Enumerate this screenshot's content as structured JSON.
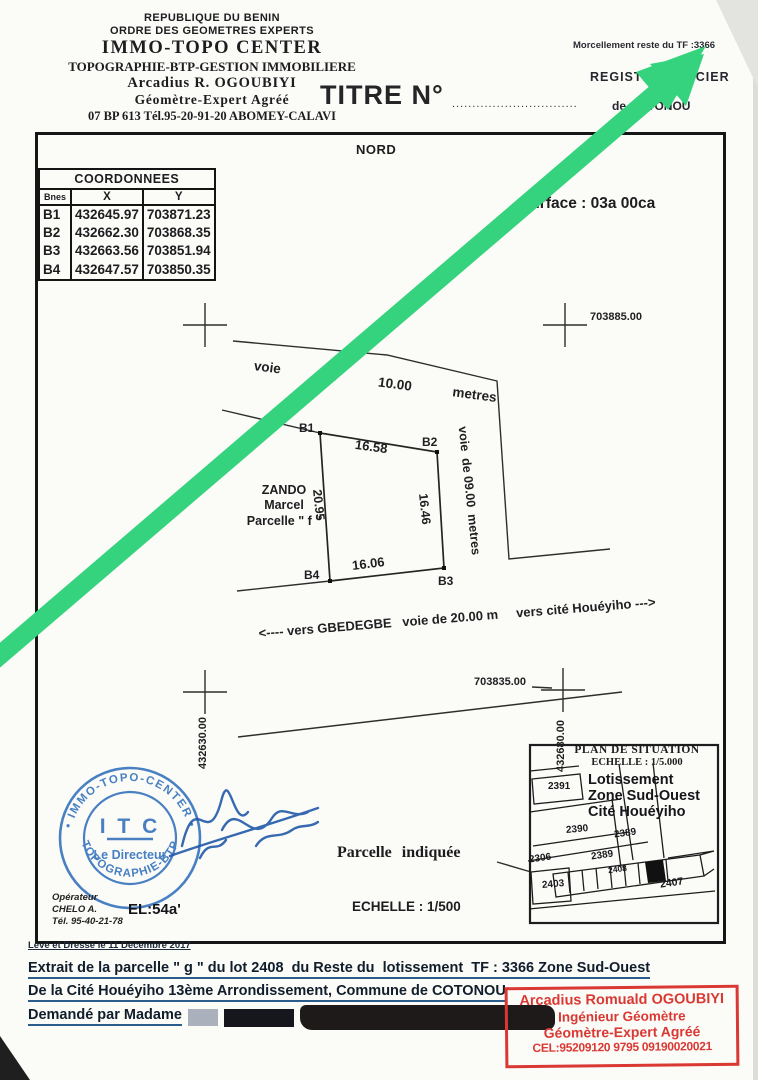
{
  "colors": {
    "arrow_green": "#36d37e",
    "stamp_blue": "#3070bb",
    "stamp_red": "#da3832"
  },
  "header": {
    "lines": [
      "REPUBLIQUE DU BENIN",
      "ORDRE DES GEOMETRES EXPERTS",
      "IMMO-TOPO CENTER",
      "TOPOGRAPHIE-BTP-GESTION IMMOBILIERE",
      "Arcadius R. OGOUBIYI",
      "Géomètre-Expert Agréé",
      "07 BP 613 Tél.95-20-91-20 ABOMEY-CALAVI"
    ],
    "title": "TITRE N°",
    "title_dots": "...............................",
    "morcellement": "Morcellement reste  du TF :3366",
    "registre_line1": "REGISTRE FONCIER",
    "registre_line2": "de COTONOU"
  },
  "plan": {
    "nord": "NORD",
    "surface": "Surface : 03a 00ca",
    "coords": {
      "title": "COORDONNEES",
      "col_b": "Bnes",
      "col_x": "X",
      "col_y": "Y",
      "rows": [
        {
          "b": "B1",
          "x": "432645.97",
          "y": "703871.23"
        },
        {
          "b": "B2",
          "x": "432662.30",
          "y": "703868.35"
        },
        {
          "b": "B3",
          "x": "432663.56",
          "y": "703851.94"
        },
        {
          "b": "B4",
          "x": "432647.57",
          "y": "703850.35"
        }
      ]
    },
    "road10": "voie   de   10.00   metres",
    "road9": "voie  de 09.00  metres",
    "road20": "<---- vers GBEDEGBE   voie de 20.00 m     vers cité Houéyiho --->",
    "points": {
      "b1": "B1",
      "b2": "B2",
      "b3": "B3",
      "b4": "B4"
    },
    "dims": {
      "top": "16.58",
      "left": "20.95",
      "right": "16.46",
      "bottom": "16.06"
    },
    "grid": {
      "ne": "703885.00",
      "se": "703835.00",
      "sw_v": "432630.00",
      "se_v": "432680.00"
    },
    "owner": {
      "l1": "ZANDO",
      "l2": "Marcel",
      "l3": "Parcelle \" f \""
    },
    "scale": "ECHELLE : 1/500",
    "pointer_label": "Parcelle  indiquée"
  },
  "situation": {
    "title": "PLAN  DE  SITUATION",
    "scale": "ECHELLE : 1/5.000",
    "zone1": "Lotissement",
    "zone2": "Zone Sud-Ouest",
    "zone3": "Cité Houéyiho",
    "lots": [
      "2391",
      "2390",
      "2389",
      "2389",
      "2306",
      "2408",
      "2403",
      "2407"
    ]
  },
  "stamp_blue": {
    "ring_top": "• IMMO-TOPO-CENTER •",
    "ring_bottom": "• TOPOGRAPHIE-BTP •",
    "center": "I T C",
    "role": "Le Directeur"
  },
  "operator": {
    "l1": "Opérateur",
    "l2": "CHELO A.",
    "l3": "Tél. 95-40-21-78",
    "el": "EL:54a'"
  },
  "footer": {
    "leve": "Levé et Dressé le 11 Décembre 2017",
    "line1": "Extrait de la parcelle \" g \" du lot 2408  du Reste du  lotissement  TF : 3366 Zone Sud-Ouest",
    "line2": "De la Cité Houéyiho 13ème Arrondissement, Commune de COTONOU",
    "line3": "Demandé par Madame"
  },
  "stamp_red": {
    "l1": "Arcadius Romuald OGOUBIYI",
    "l2": "Ingénieur  Géomètre",
    "l3": "Géomètre-Expert Agréé",
    "l4": "CEL:95209120 9795 09190020021"
  }
}
